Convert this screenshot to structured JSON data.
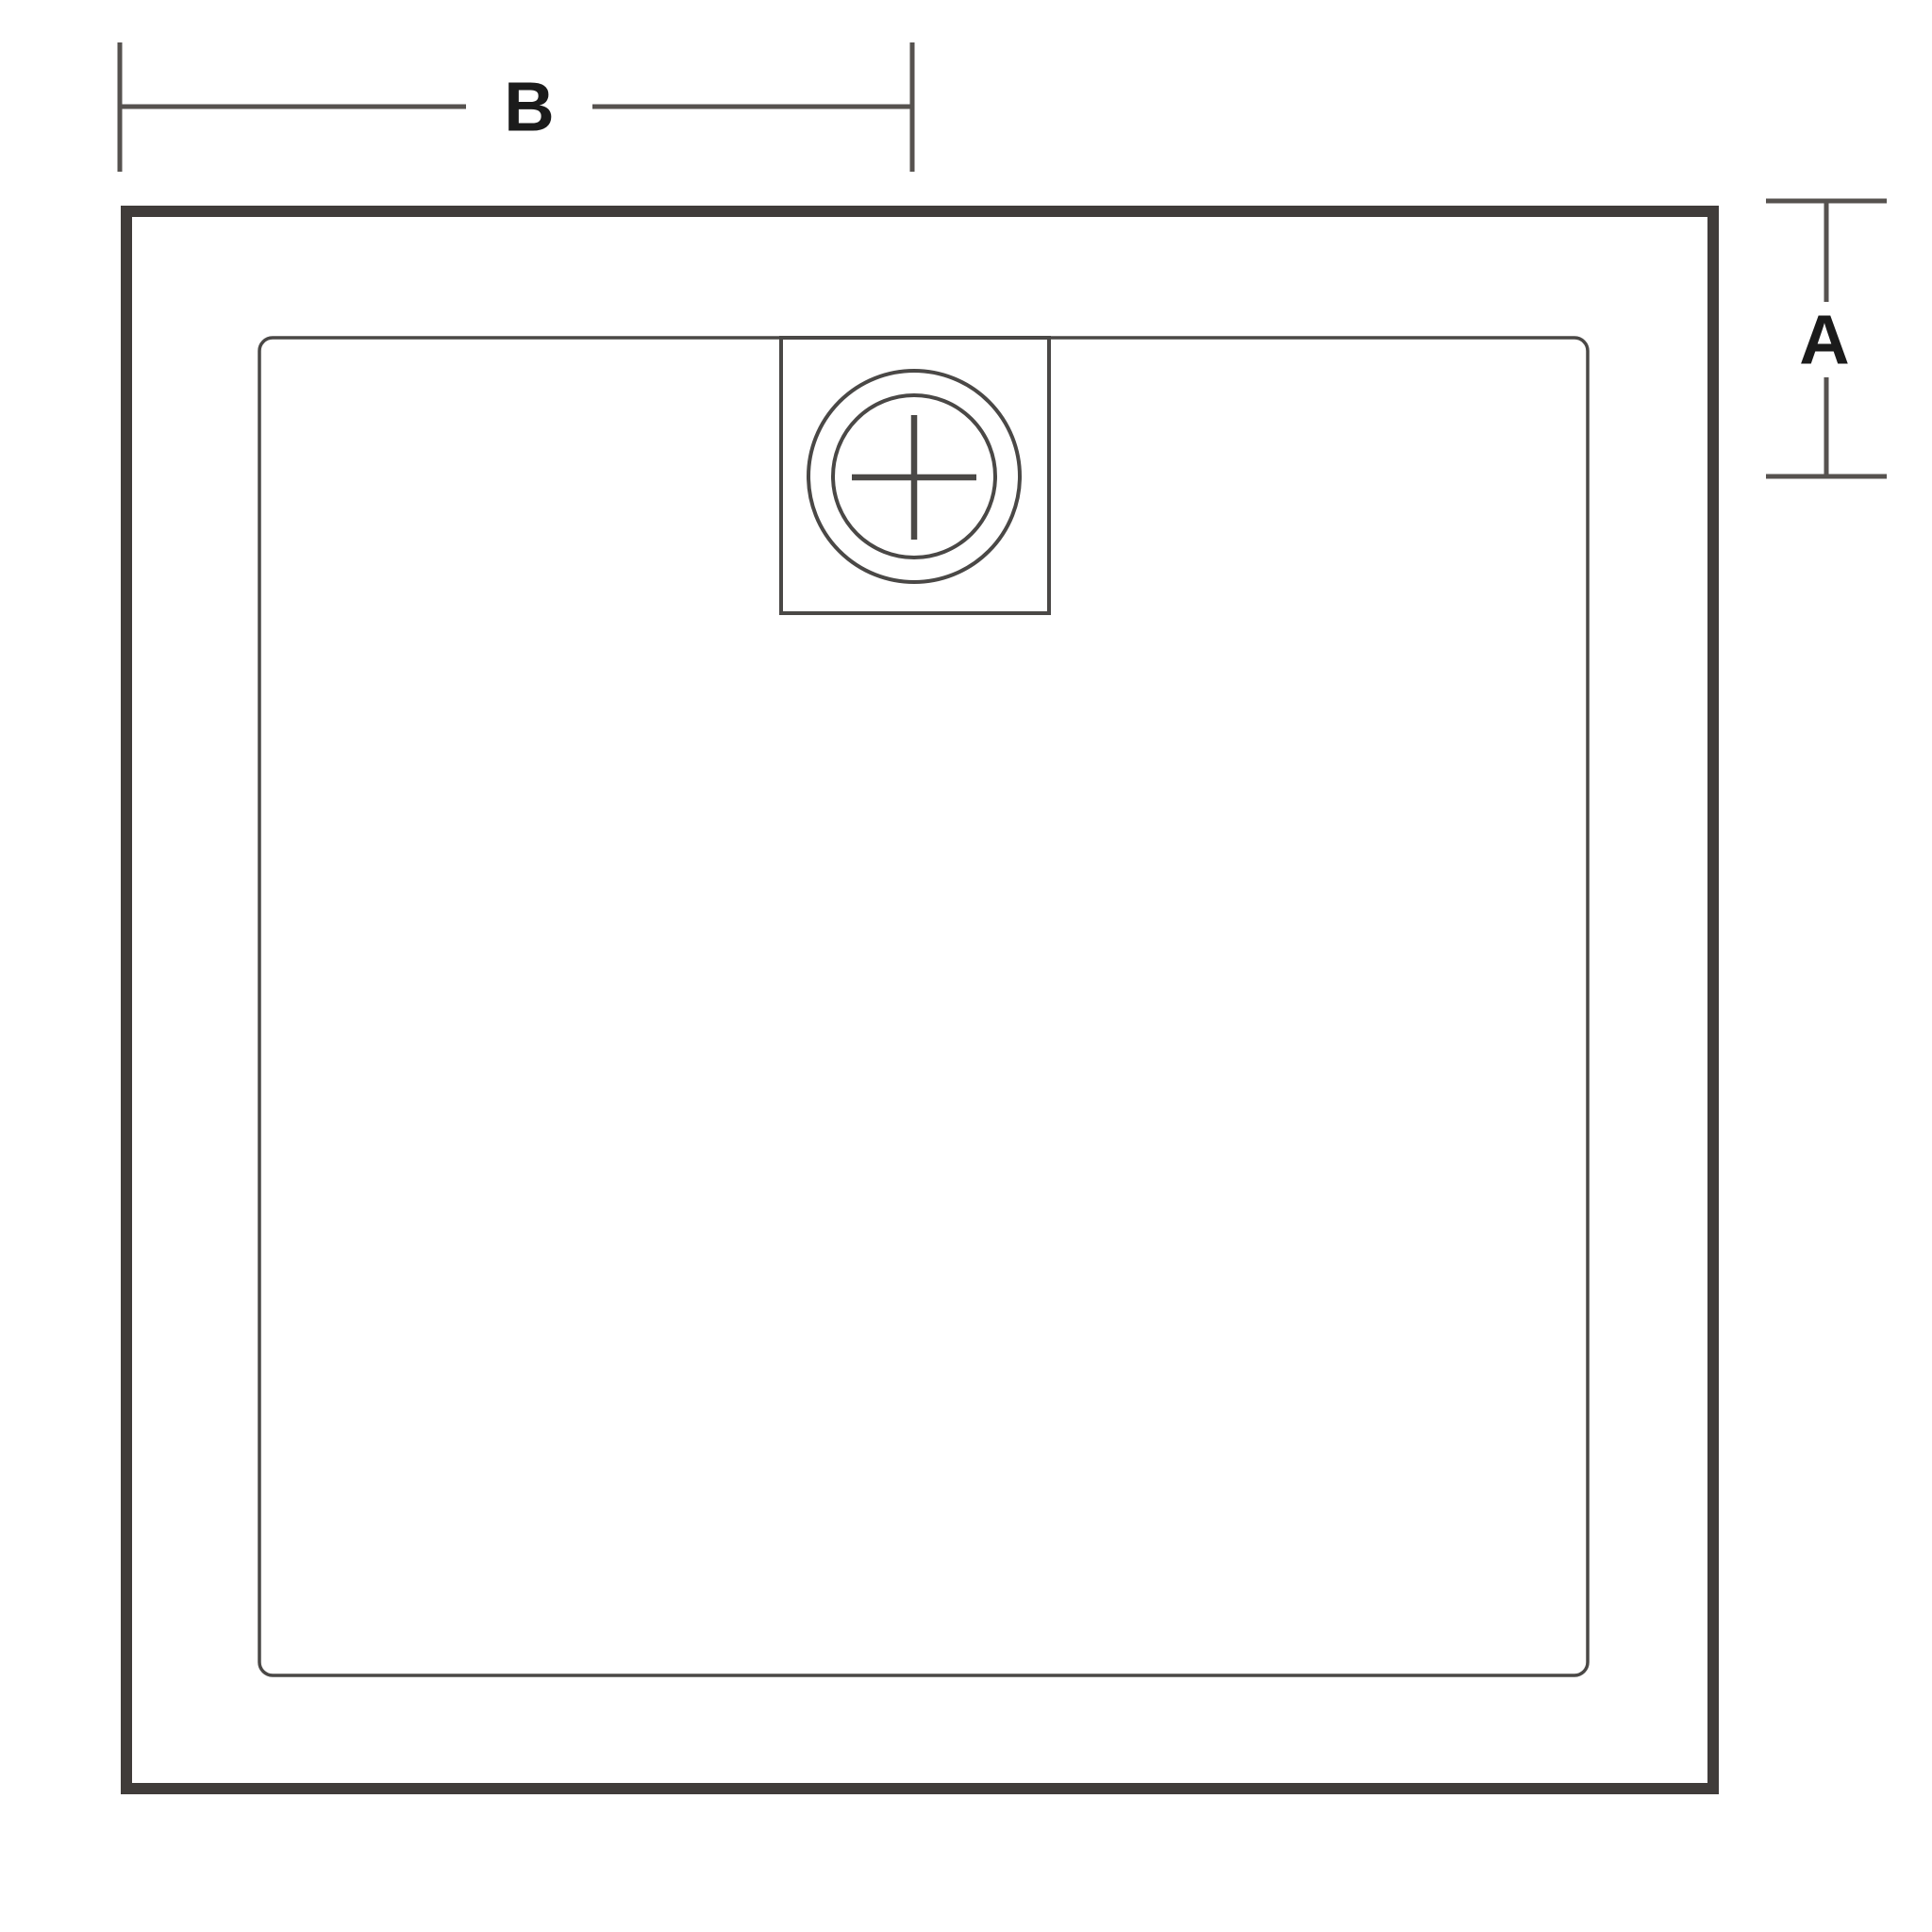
{
  "dimensions": {
    "horizontal_label": "B",
    "vertical_label": "A"
  },
  "colors": {
    "bg": "#ffffff",
    "outline": "#403c3a",
    "line": "#4a4846",
    "dim-line": "#56524f",
    "label": "#1b1b1b"
  }
}
